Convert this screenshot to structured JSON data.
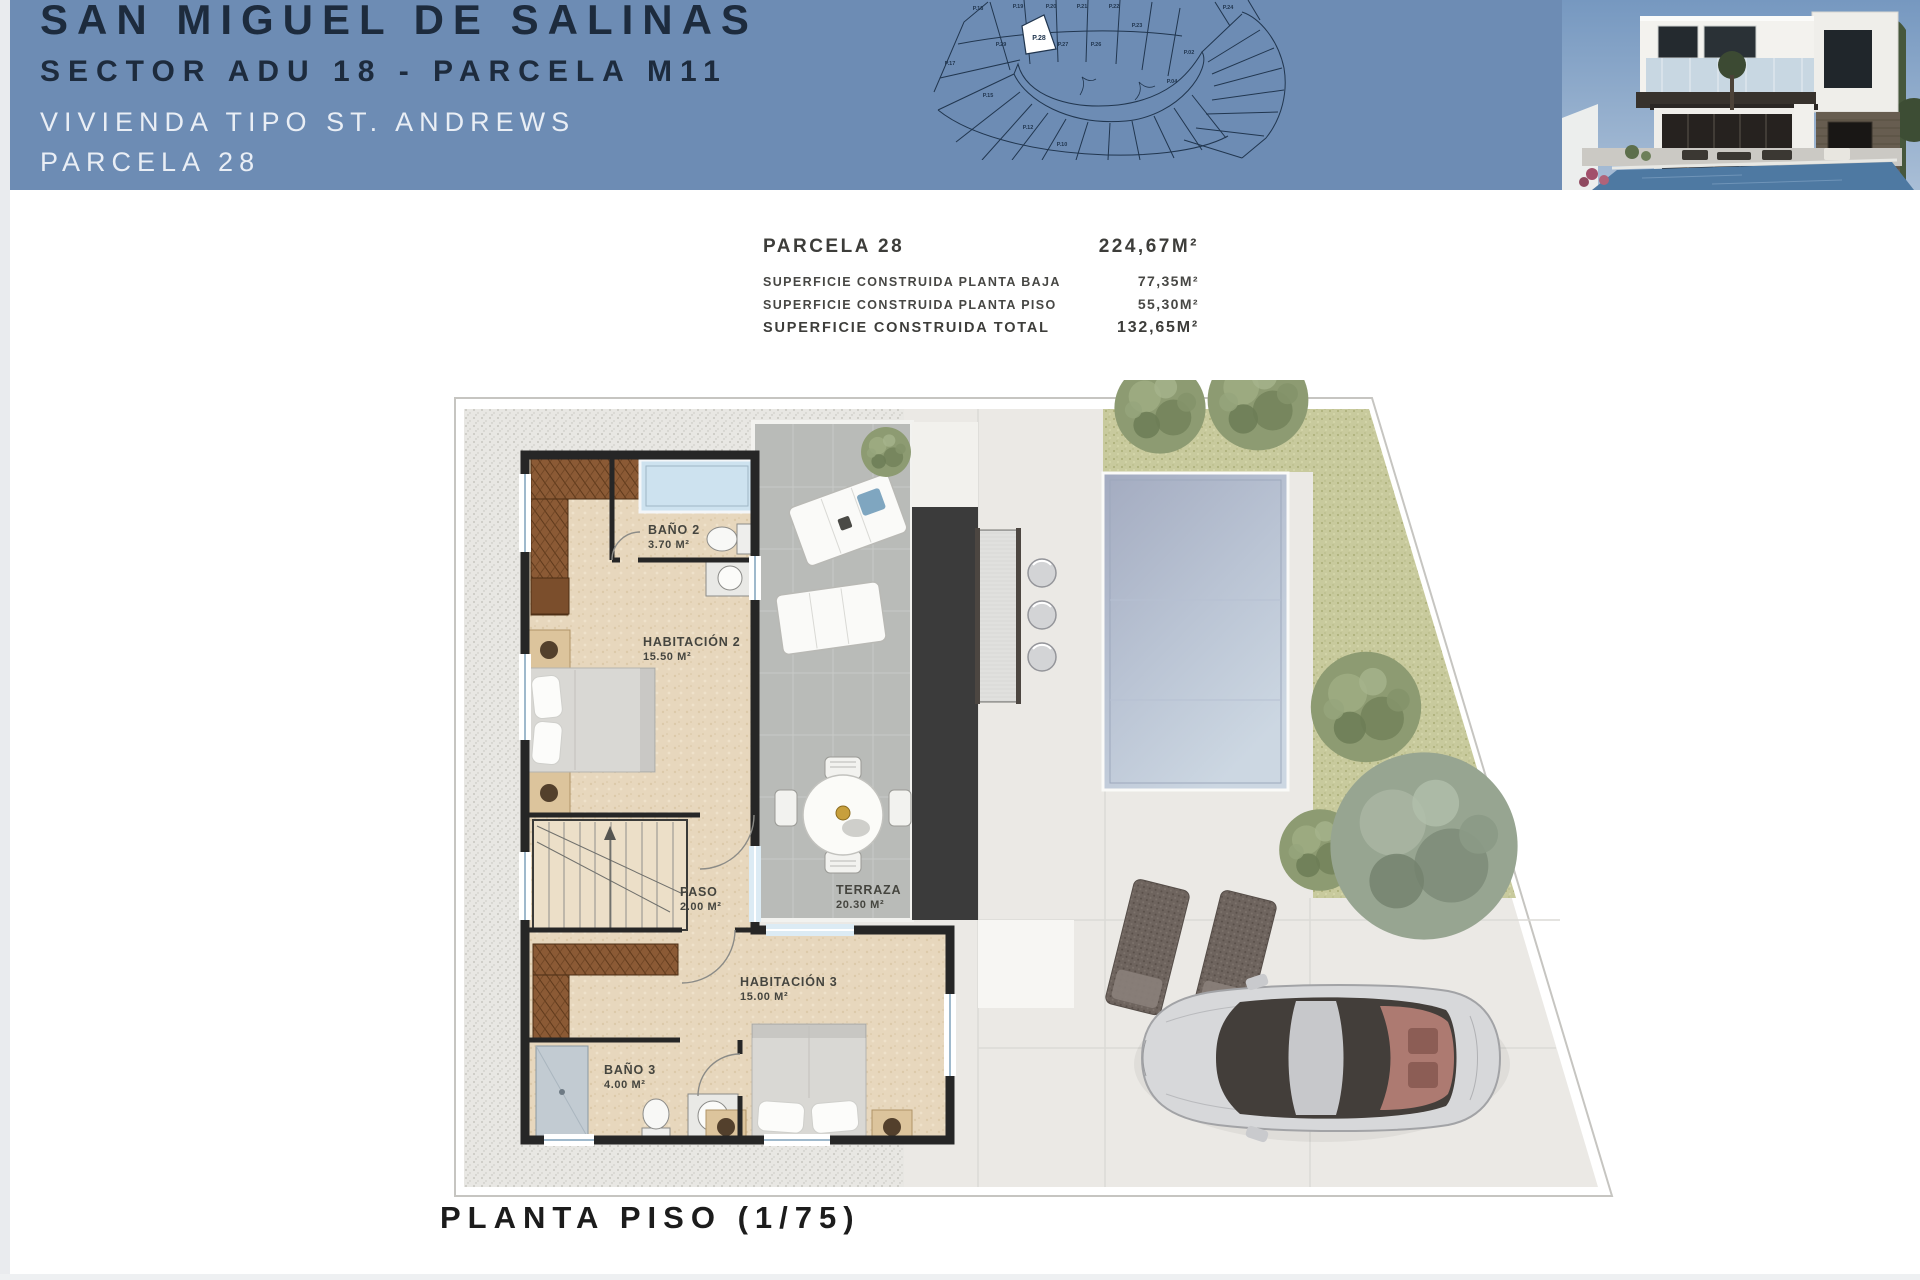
{
  "header": {
    "line1": "SAN MIGUEL DE SALINAS",
    "line2": "SECTOR ADU 18 - PARCELA M11",
    "line3": "VIVIENDA TIPO ST. ANDREWS",
    "line4": "PARCELA 28",
    "site_map": {
      "highlighted_parcel": "P.28",
      "parcel_labels": [
        "P.18",
        "P.19",
        "P.20",
        "P.21",
        "P.22",
        "P.23",
        "P.24",
        "P.29",
        "P.27",
        "P.26",
        "P.17",
        "P.15",
        "P.12",
        "P.10",
        "P.02",
        "P.04"
      ]
    }
  },
  "area_table": {
    "rows": [
      {
        "label": "PARCELA 28",
        "value": "224,67M²"
      },
      {
        "label": "SUPERFICIE CONSTRUIDA PLANTA BAJA",
        "value": "77,35M²"
      },
      {
        "label": "SUPERFICIE CONSTRUIDA PLANTA PISO",
        "value": "55,30M²"
      },
      {
        "label": "SUPERFICIE CONSTRUIDA TOTAL",
        "value": "132,65M²"
      }
    ]
  },
  "floor_plan": {
    "rooms": [
      {
        "name": "BAÑO 2",
        "area": "3.70 M²"
      },
      {
        "name": "HABITACIÓN 2",
        "area": "15.50 M²"
      },
      {
        "name": "PASO",
        "area": "2.00 M²"
      },
      {
        "name": "TERRAZA",
        "area": "20.30 M²"
      },
      {
        "name": "HABITACIÓN 3",
        "area": "15.00 M²"
      },
      {
        "name": "BAÑO 3",
        "area": "4.00 M²"
      }
    ],
    "scale_label": "PLANTA PISO (1/75)"
  },
  "colors": {
    "header_blue": "#6d8cb4",
    "title_navy": "#1d2b3d",
    "pool_blue": "#b7c2d4",
    "grass_green": "#c8ca9d"
  }
}
